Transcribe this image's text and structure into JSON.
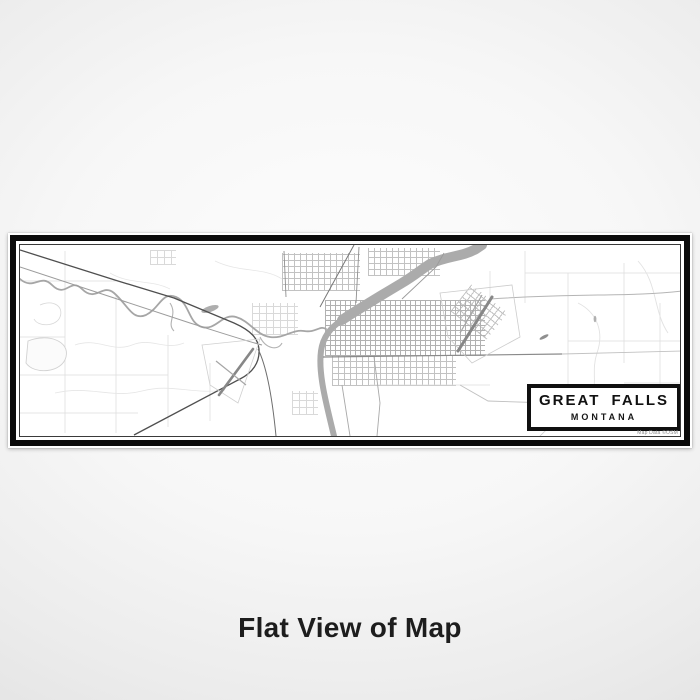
{
  "map": {
    "title": "GREAT FALLS",
    "subtitle": "MONTANA",
    "attribution": "Map Data ©OSM"
  },
  "caption": "Flat View of Map",
  "colors": {
    "frame_black": "#0b0b0b",
    "paper_white": "#ffffff",
    "river_gray": "#ababab",
    "road_dark": "#4f4f4f",
    "street_grid_gray": "#9e9e9e",
    "background_gray": "#ececec",
    "caption_text": "#1d1d1d"
  }
}
